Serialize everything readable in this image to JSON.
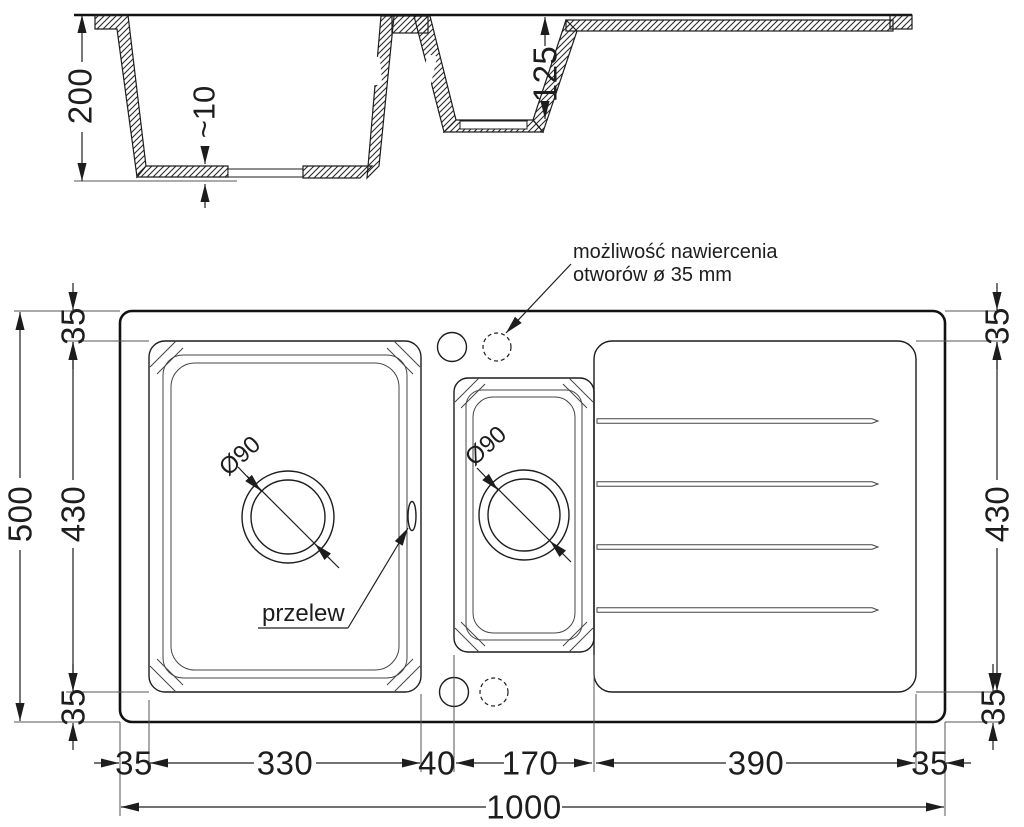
{
  "annotations": {
    "drill_note_line1": "możliwość nawiercenia",
    "drill_note_line2": "otworów ø 35 mm",
    "overflow": "przelew"
  },
  "section_dims": {
    "depth": "200",
    "floor_thickness": "~10",
    "bowl2_depth": "125"
  },
  "plan_dims": {
    "overall_height": "500",
    "bowl_height_left": "430",
    "bowl_height_right": "430",
    "margin_top_left": "35",
    "margin_bottom_left": "35",
    "margin_top_right": "35",
    "margin_bottom_right": "35",
    "bottom_left_margin": "35",
    "bowl1_width": "330",
    "divider_width": "40",
    "bowl2_width": "170",
    "drainer_width": "390",
    "bottom_right_margin": "35",
    "overall_width": "1000",
    "drain1_diameter": "Ø90",
    "drain2_diameter": "Ø90"
  },
  "colors": {
    "line": "#1d1d1d",
    "background": "#ffffff"
  }
}
